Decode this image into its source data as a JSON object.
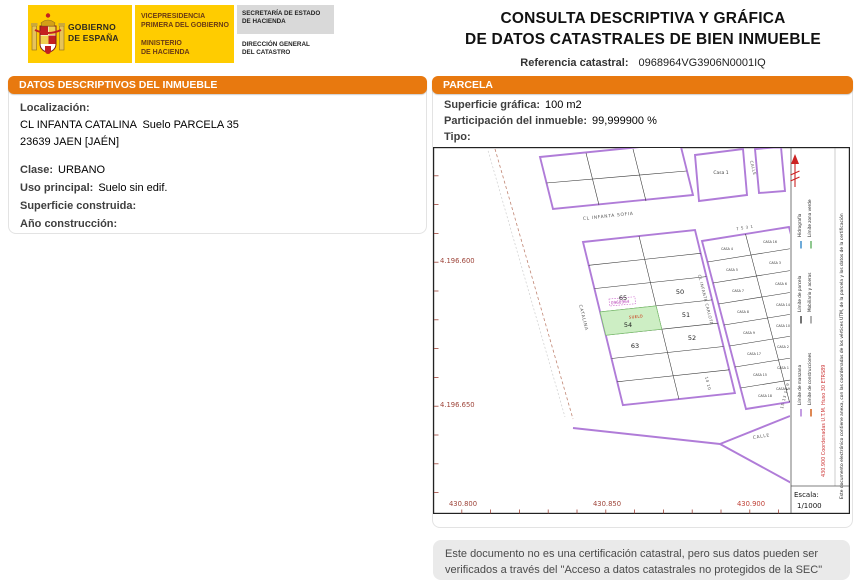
{
  "header": {
    "title_line1": "CONSULTA DESCRIPTIVA Y GRÁFICA",
    "title_line2": "DE DATOS CATASTRALES DE BIEN INMUEBLE",
    "ref_label": "Referencia catastral:",
    "ref_value": "0968964VG3906N0001IQ",
    "logo": {
      "gobierno_line1": "GOBIERNO",
      "gobierno_line2": "DE ESPAÑA",
      "vice_line1": "VICEPRESIDENCIA",
      "vice_line2": "PRIMERA DEL GOBIERNO",
      "min_line1": "MINISTERIO",
      "min_line2": "DE HACIENDA",
      "sec_line1": "SECRETARÍA DE ESTADO",
      "sec_line2": "DE HACIENDA",
      "dir_line1": "DIRECCIÓN GENERAL",
      "dir_line2": "DEL CATASTRO"
    }
  },
  "datos": {
    "header": "DATOS DESCRIPTIVOS DEL INMUEBLE",
    "localizacion_label": "Localización:",
    "direccion": "CL INFANTA CATALINA  Suelo PARCELA 35",
    "municipio": "23639 JAEN [JAÉN]",
    "clase_label": "Clase:",
    "clase": "URBANO",
    "uso_label": "Uso principal:",
    "uso": "Suelo sin edif.",
    "superficie_label": "Superficie construida:",
    "superficie": "",
    "anio_label": "Año construcción:",
    "anio": ""
  },
  "parcela": {
    "header": "PARCELA",
    "superficie_label": "Superficie gráfica:",
    "superficie": "100 m2",
    "participacion_label": "Participación del inmueble:",
    "participacion": "99,999900 %",
    "tipo_label": "Tipo:",
    "tipo": ""
  },
  "map": {
    "x_labels": [
      "430.800",
      "430.850",
      "430.900"
    ],
    "y_labels": [
      "4.196.600",
      "4.196.650"
    ],
    "streets": {
      "sofia": "CL    INFANTA    SOFIA",
      "catalina": "CATALINA",
      "carlota": "CL INFANTA CARLOTA",
      "calle_top": "CALLE",
      "calle_bottom": "CALLE"
    },
    "parcels": {
      "p65": "65",
      "p50": "50",
      "p51": "51",
      "p52": "52",
      "p63": "63"
    },
    "highlight": {
      "number": "54",
      "suelo": "SUELO",
      "ref": "0968964"
    },
    "casa_top": "Casa 1",
    "casa_labels": [
      "CASA 4",
      "CASA 16",
      "CASA 5",
      "CASA 3",
      "CASA 7",
      "CASA 6",
      "CASA 8",
      "CASA 14",
      "CASA 9",
      "CASA 10",
      "CASA 17",
      "CASA 2",
      "CASA 15",
      "CASA 1",
      "CASA 18",
      "CASA 19"
    ],
    "house_numbers": {
      "top": "7      5      3      1",
      "right": "15    13    11    9",
      "left": "14      10"
    },
    "legend": {
      "items": [
        {
          "label": "Límite de manzana",
          "color": "#b07cd8"
        },
        {
          "label": "Límite de construcciones",
          "color": "#d2601a"
        },
        {
          "label": "Límite de parcela",
          "color": "#444444"
        },
        {
          "label": "Mobiliario y aceras",
          "color": "#999999"
        },
        {
          "label": "Hidrografía",
          "color": "#3f8fcc"
        },
        {
          "label": "Límite zona verde",
          "color": "#6ab56a"
        }
      ],
      "coords_note": "430.900 Coordenadas U.T.M. Huso 30 ETRS89",
      "doc_note": "Este documento electrónico contiene anexa, con las coordenadas de los vértices UTM, de la parcela y los datos de la certificación"
    },
    "escala_label": "Escala:",
    "escala_value": "1/1000"
  },
  "footer": {
    "note": "Este documento no es una certificación catastral, pero sus datos pueden ser verificados a través del \"Acceso a datos catastrales no protegidos de la SEC\""
  }
}
